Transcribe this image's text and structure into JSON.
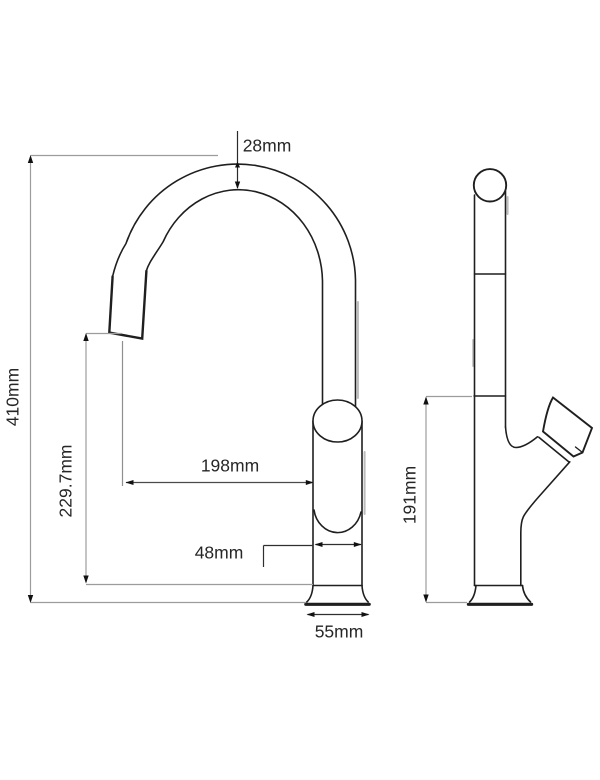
{
  "document": {
    "type": "technical-dimension-drawing",
    "subject": "kitchen faucet (gooseneck mixer tap), front view and side view",
    "background_color": "#ffffff",
    "outline_color": "#1f1f1f",
    "dimension_line_color": "#9c9c9c",
    "text_color": "#262626"
  },
  "views": {
    "front": {
      "name": "front-view"
    },
    "side": {
      "name": "side-view"
    }
  },
  "dimensions": {
    "spout_diameter": {
      "label": "28mm",
      "orientation": "horizontal",
      "measures": "spout tube diameter at top of arc"
    },
    "total_height": {
      "label": "410mm",
      "orientation": "vertical-rotated",
      "measures": "overall faucet height"
    },
    "spout_tip_height": {
      "label": "229.7mm",
      "orientation": "vertical-rotated",
      "measures": "height from base top to spout outlet"
    },
    "spout_reach": {
      "label": "198mm",
      "orientation": "horizontal",
      "measures": "horizontal reach from outlet to body"
    },
    "body_width": {
      "label": "48mm",
      "orientation": "horizontal",
      "measures": "body diameter"
    },
    "base_width": {
      "label": "55mm",
      "orientation": "horizontal",
      "measures": "base flange width"
    },
    "side_height": {
      "label": "191mm",
      "orientation": "vertical-rotated",
      "measures": "body height in side view"
    }
  }
}
